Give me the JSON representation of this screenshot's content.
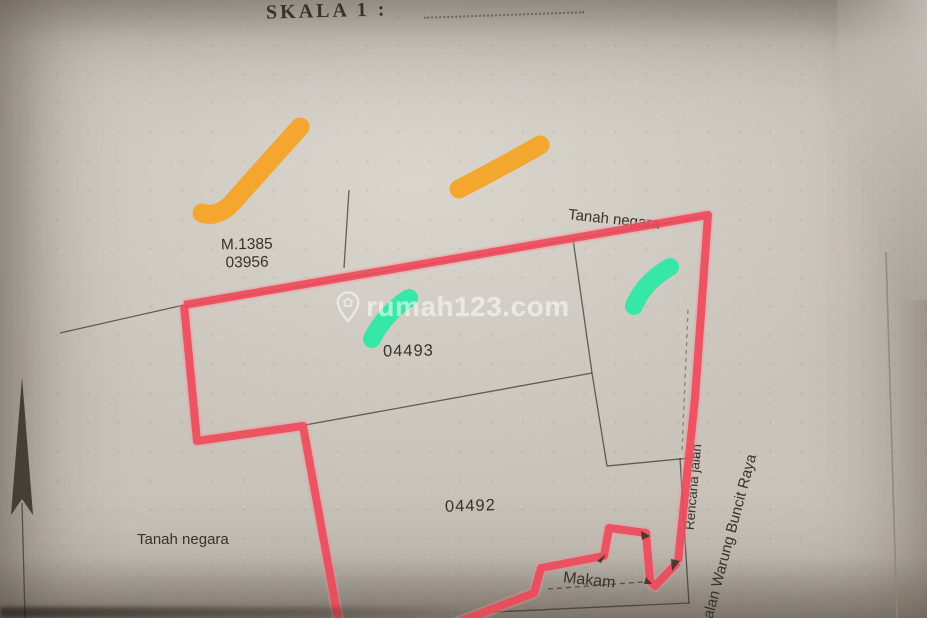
{
  "scan": {
    "title": "SKALA 1 :",
    "watermark": {
      "text": "rumah123.com",
      "icon": "map-pin-house-icon"
    },
    "labels": {
      "parcel_ref": {
        "line1": "M.1385",
        "line2": "03956"
      },
      "tanah_negara_top": "Tanah negara",
      "parcel_a": "04493",
      "parcel_b": "04492",
      "tanah_negara_left": "Tanah negara",
      "makam": "Makam",
      "rencana_jalan": "Rencana jalan",
      "street_name": "Jalan Warung Buncit Raya"
    },
    "colors": {
      "paper": "#c9c3ba",
      "pencil": "#37332a",
      "boundary-red": "#ee4758",
      "boundary-red-glow": "#f7909b",
      "highlight-orange": "#f6a322",
      "highlight-teal": "#2ee8a6",
      "watermark-white": "#ffffff",
      "crease": "#8d8577"
    }
  }
}
